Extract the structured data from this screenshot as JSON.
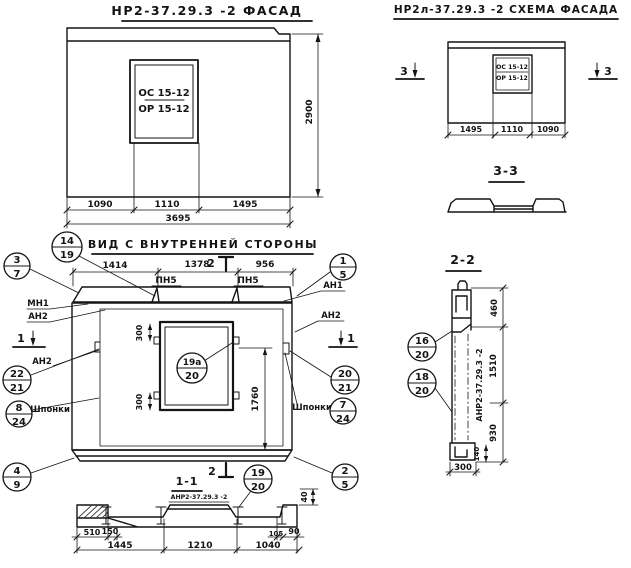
{
  "drawing": {
    "facade": {
      "title": "НР2-37.29.3 -2 ФАСАД",
      "opening_top": "ОС 15-12",
      "opening_bottom": "ОР 15-12",
      "dim_1090": "1090",
      "dim_1110": "1110",
      "dim_1495": "1495",
      "dim_total": "3695",
      "dim_height": "2900"
    },
    "schema": {
      "title": "НР2л-37.29.3 -2 СХЕМА ФАСАДА",
      "opening_top": "ОС 15-12",
      "opening_bottom": "ОР 15-12",
      "dim_1495": "1495",
      "dim_1110": "1110",
      "dim_1090": "1090",
      "section_mark": "3"
    },
    "section33": {
      "title": "3-3"
    },
    "inner_view": {
      "title": "ВИД С ВНУТРЕННЕЙ СТОРОНЫ",
      "dim_1414": "1414",
      "dim_1378": "1378",
      "dim_956": "956",
      "pn5_left": "ПН5",
      "pn5_right": "ПН5",
      "label_mn1": "МН1",
      "label_an2_left": "АН2",
      "label_an2_left2": "АН2",
      "label_an1": "АН1",
      "label_an2_right": "АН2",
      "label_shponki_left": "Шпонки",
      "label_shponki_right": "Шпонки",
      "dim_300_top": "300",
      "dim_300_bottom": "300",
      "dim_1760": "1760",
      "mark_1_left": "1",
      "mark_1_right": "1",
      "mark_2_top": "2",
      "mark_2_bottom": "2"
    },
    "section11": {
      "title": "1-1",
      "subtitle": "АНР2-37.29.3 -2",
      "dim_510": "510",
      "dim_150": "150",
      "dim_105": "105",
      "dim_90": "90",
      "dim_1445": "1445",
      "dim_1210": "1210",
      "dim_1040": "1040",
      "dim_40": "40"
    },
    "section22": {
      "title": "2-2",
      "panel_mark": "АНР2-37.29.3 -2",
      "dim_460": "460",
      "dim_1510": "1510",
      "dim_930": "930",
      "dim_140": "140",
      "dim_300": "300"
    },
    "callouts": {
      "c14_19": {
        "top": "14",
        "bottom": "19"
      },
      "c3_7": {
        "top": "3",
        "bottom": "7"
      },
      "c1_5": {
        "top": "1",
        "bottom": "5"
      },
      "c22_21": {
        "top": "22",
        "bottom": "21"
      },
      "c8_24": {
        "top": "8",
        "bottom": "24"
      },
      "c4_9": {
        "top": "4",
        "bottom": "9"
      },
      "c20_21": {
        "top": "20",
        "bottom": "21"
      },
      "c7_24": {
        "top": "7",
        "bottom": "24"
      },
      "c19a_20": {
        "top": "19а",
        "bottom": "20"
      },
      "c19_20": {
        "top": "19",
        "bottom": "20"
      },
      "c2_5": {
        "top": "2",
        "bottom": "5"
      },
      "c16_20": {
        "top": "16",
        "bottom": "20"
      },
      "c18_20": {
        "top": "18",
        "bottom": "20"
      }
    }
  }
}
